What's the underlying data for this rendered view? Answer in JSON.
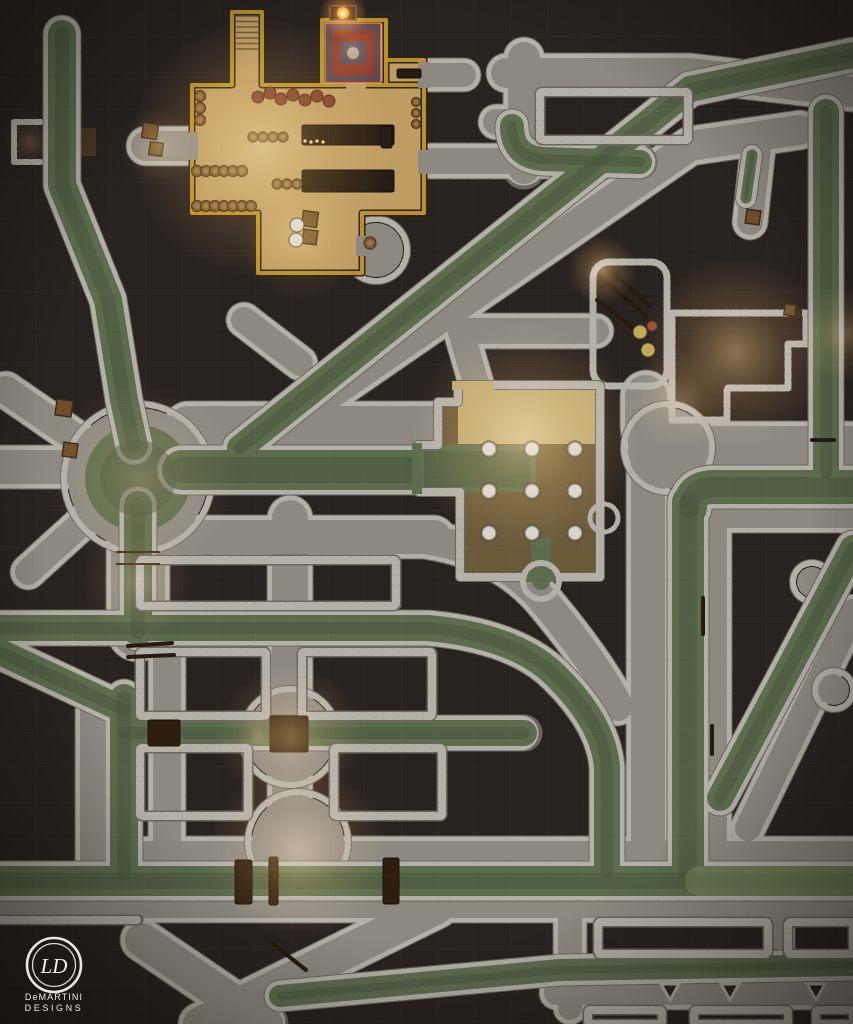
{
  "logo": {
    "monogram": "LD",
    "line1": "DeMARTINI",
    "line2": "DESIGNS"
  },
  "palette": {
    "bg": "#292320",
    "stone": "#b3b0a8",
    "joint": "#6b675f",
    "street": "#8d8981",
    "streetlit": "#b5a37c",
    "water": "#5c6d4e",
    "waterdark": "#46543c",
    "waterbright": "#7e9060",
    "tfloor": "#bf9c62",
    "gold": "#b8902c",
    "golddark": "#2e2312",
    "wood": "#3a2a16",
    "pillar": "#d8d4ca",
    "fire": "#ff8a30",
    "glow": "#f0a84f",
    "carpet_red": "#8a3b2c",
    "carpet_blue": "#3f5068"
  },
  "grid": {
    "size": 36.5,
    "line_opacity": 0.055
  },
  "map": {
    "streets": [
      {
        "d": "M146,146 H198",
        "w": 30
      },
      {
        "d": "M430,75 H464",
        "w": 24
      },
      {
        "d": "M506,73 H690 L853,92",
        "w": 30
      },
      {
        "d": "M524,58 V168",
        "w": 32
      },
      {
        "d": "M522,122 H496",
        "w": 26
      },
      {
        "d": "M430,161 H640",
        "w": 26
      },
      {
        "d": "M800,130 L690,146 L236,459",
        "w": 30
      },
      {
        "d": "M244,320 L300,363",
        "w": 26
      },
      {
        "d": "M470,331 H596",
        "w": 26
      },
      {
        "d": "M646,396 V424 Q646,447 670,447 H853",
        "w": 42
      },
      {
        "d": "M716,440 V872",
        "w": 22
      },
      {
        "d": "M648,460 V872",
        "w": 34
      },
      {
        "d": "M430,540 Q505,552 548,606 Q596,664 618,706",
        "w": 30
      },
      {
        "d": "M158,537 H434",
        "w": 34
      },
      {
        "d": "M290,518 V872",
        "w": 36
      },
      {
        "d": "M138,504 V630",
        "w": 54
      },
      {
        "d": "M0,467 H94",
        "w": 34
      },
      {
        "d": "M6,390 L96,452",
        "w": 28
      },
      {
        "d": "M28,572 L94,512",
        "w": 26
      },
      {
        "d": "M160,512 L208,542",
        "w": 26
      },
      {
        "d": "M188,426 H456",
        "w": 40
      },
      {
        "d": "M148,854 H853",
        "w": 26
      },
      {
        "d": "M0,907 H853",
        "w": 22
      },
      {
        "d": "M92,700 V862",
        "w": 24
      },
      {
        "d": "M167,648 V856",
        "w": 28
      },
      {
        "d": "M437,907 L200,1024",
        "w": 34
      },
      {
        "d": "M142,940 L266,1024",
        "w": 34
      },
      {
        "d": "M570,893 V1008",
        "w": 24
      },
      {
        "d": "M556,993 H853",
        "w": 24
      },
      {
        "d": "M780,918 V958",
        "w": 20
      },
      {
        "d": "M853,612 L748,828",
        "w": 26
      },
      {
        "d": "M758,148 L750,222",
        "w": 26
      },
      {
        "d": "M460,328 L478,390",
        "w": 26
      },
      {
        "d": "M710,518 H853",
        "w": 20
      }
    ],
    "aprons": [
      [
        138,
        478,
        70
      ],
      [
        290,
        737,
        44
      ],
      [
        298,
        842,
        46
      ],
      [
        668,
        448,
        40
      ],
      [
        376,
        250,
        27
      ],
      [
        812,
        582,
        15
      ],
      [
        834,
        690,
        15
      ]
    ],
    "channels": [
      {
        "d": "M62,34 V185 L108,300 L124,400 L134,446",
        "w": 28
      },
      {
        "d": "M182,470 H444",
        "w": 40
      },
      {
        "d": "M138,505 V632",
        "w": 28
      },
      {
        "d": "M0,628 H428 Q518,636 558,678 Q604,724 607,768 V872",
        "w": 26
      },
      {
        "d": "M124,733 H524",
        "w": 26
      },
      {
        "d": "M124,698 V874",
        "w": 28
      },
      {
        "d": "M0,652 L124,710",
        "w": 26
      },
      {
        "d": "M0,881 H853",
        "w": 30
      },
      {
        "d": "M280,996 L560,970 L853,965",
        "w": 22
      },
      {
        "d": "M688,502 V874",
        "w": 32
      },
      {
        "d": "M853,487 H714 Q690,487 690,508",
        "w": 34
      },
      {
        "d": "M826,112 V472",
        "w": 26
      },
      {
        "d": "M853,55 L690,89 L240,448",
        "w": 26
      },
      {
        "d": "M512,126 Q512,156 542,159 L640,162",
        "w": 24
      },
      {
        "d": "M853,548 L720,798",
        "w": 26
      },
      {
        "d": "M752,155 L746,198",
        "w": 11
      },
      {
        "d": "M700,881 H853",
        "w": 30,
        "bright": true
      }
    ],
    "pools": [
      [
        138,
        478,
        53
      ]
    ],
    "pool_inner": [
      [
        138,
        478,
        38
      ]
    ],
    "blocks": [
      [
        140,
        560,
        256,
        46
      ],
      [
        140,
        652,
        126,
        64
      ],
      [
        302,
        652,
        130,
        64
      ],
      [
        140,
        748,
        108,
        68
      ],
      [
        334,
        748,
        108,
        68
      ],
      [
        540,
        92,
        148,
        48
      ],
      [
        598,
        922,
        170,
        32
      ],
      [
        788,
        922,
        65,
        32
      ],
      [
        588,
        1010,
        74,
        14
      ],
      [
        694,
        1010,
        94,
        14
      ],
      [
        816,
        1010,
        37,
        14
      ]
    ],
    "wall_segments": [
      [
        0,
        920,
        138,
        920
      ]
    ],
    "triangles": [
      [
        670,
        984
      ],
      [
        730,
        984
      ],
      [
        816,
        984
      ]
    ]
  },
  "rooms": {
    "tavern": {
      "floor_d": "M192,85 L232,85 L232,12 L262,12 L262,85 L322,85 L322,20 L386,20 L386,60 L424,60 L424,213 L362,213 L362,273 L258,273 L258,213 L192,213 Z",
      "interior_d": "M322,85 L424,85 M386,20 L386,85",
      "door_rects": [
        [
          186,
          132,
          12,
          28,
          "s"
        ],
        [
          418,
          62,
          12,
          26,
          "s"
        ],
        [
          418,
          150,
          12,
          24,
          "s"
        ],
        [
          356,
          236,
          12,
          20,
          "s"
        ],
        [
          346,
          81,
          20,
          8,
          "f"
        ]
      ]
    },
    "pillar_room": {
      "floor_d": "M438,402 L458,402 L458,385 L600,385 L600,577 L460,577 L460,492 L418,492 L418,445 L438,445 Z",
      "floor_color": "#6a5a3a",
      "lit_rect": [
        458,
        386,
        142,
        58,
        "#bfa871"
      ],
      "pool_rect": [
        418,
        445,
        118,
        47
      ],
      "pool_dark": [
        424,
        451,
        106,
        36
      ],
      "stub_rect": [
        531,
        538,
        20,
        40
      ],
      "gaps": [
        [
          452,
          381,
          42,
          9,
          "#bfa871"
        ],
        [
          412,
          443,
          10,
          51,
          "w"
        ],
        [
          526,
          572,
          30,
          10,
          "w"
        ]
      ],
      "outfall": [
        541,
        581,
        18,
        9
      ],
      "bump": [
        604,
        518,
        14
      ]
    },
    "platform": [
      593,
      262,
      74,
      124,
      16
    ],
    "courtyard": {
      "d": "M672,313 L806,313 L806,344 L788,344 L788,388 L727,388 L727,420 L672,420 Z",
      "floor_color": "#a8977b",
      "door": [
        788,
        308,
        14,
        10
      ]
    },
    "alcove": [
      14,
      122,
      48,
      40
    ],
    "gate": [
      70,
      128,
      26,
      28
    ]
  },
  "props": {
    "bridges": [
      [
        235,
        860,
        17,
        44
      ],
      [
        269,
        857,
        9,
        48
      ],
      [
        383,
        858,
        16,
        46
      ],
      [
        270,
        716,
        38,
        36
      ],
      [
        148,
        720,
        32,
        26
      ]
    ],
    "beams": [
      [
        128,
        646,
        172,
        643
      ],
      [
        128,
        657,
        174,
        655
      ],
      [
        273,
        944,
        306,
        970
      ],
      [
        600,
        276,
        646,
        316
      ],
      [
        610,
        270,
        650,
        306
      ],
      [
        597,
        300,
        638,
        332
      ],
      [
        703,
        598,
        703,
        634
      ],
      [
        712,
        726,
        712,
        754
      ],
      [
        812,
        440,
        834,
        440
      ]
    ],
    "rails": [
      [
        116,
        552,
        160,
        552
      ],
      [
        116,
        564,
        160,
        564
      ]
    ],
    "crates": [
      [
        150,
        131,
        15
      ],
      [
        156,
        149,
        13
      ],
      [
        64,
        408,
        16
      ],
      [
        70,
        450,
        14
      ],
      [
        753,
        217,
        14
      ],
      [
        790,
        310,
        11
      ],
      [
        310,
        219,
        15
      ],
      [
        310,
        237,
        14
      ]
    ],
    "sacks": [
      [
        640,
        332,
        7,
        "#c2a85a"
      ],
      [
        648,
        350,
        7,
        "#c2a85a"
      ],
      [
        297,
        225,
        7,
        "#d8d2c4"
      ],
      [
        296,
        240,
        7,
        "#d8d2c4"
      ],
      [
        652,
        326,
        5,
        "#a84a30"
      ]
    ],
    "barrels": [
      [
        197,
        171,
        5.5
      ],
      [
        206,
        171,
        5.5
      ],
      [
        215,
        171,
        5.5
      ],
      [
        224,
        171,
        5.5
      ],
      [
        233,
        171,
        5.5
      ],
      [
        242,
        171,
        5.5
      ],
      [
        197,
        206,
        5.5
      ],
      [
        206,
        206,
        5.5
      ],
      [
        215,
        206,
        5.5
      ],
      [
        224,
        206,
        5.5
      ],
      [
        233,
        206,
        5.5
      ],
      [
        242,
        206,
        5.5
      ],
      [
        251,
        206,
        5.5
      ],
      [
        200,
        96,
        5.5
      ],
      [
        200,
        108,
        5.5
      ],
      [
        200,
        120,
        5.5
      ],
      [
        253,
        137,
        5
      ],
      [
        263,
        137,
        5
      ],
      [
        273,
        137,
        5
      ],
      [
        283,
        137,
        5
      ],
      [
        277,
        184,
        5
      ],
      [
        287,
        184,
        5
      ],
      [
        297,
        184,
        5
      ],
      [
        416,
        102,
        4.5
      ],
      [
        416,
        113,
        4.5
      ],
      [
        416,
        124,
        4.5
      ],
      [
        370,
        243,
        6
      ]
    ],
    "red_sacks": [
      [
        258,
        97
      ],
      [
        270,
        93
      ],
      [
        281,
        99
      ],
      [
        293,
        95
      ],
      [
        305,
        100
      ],
      [
        317,
        96
      ],
      [
        329,
        101
      ]
    ],
    "tables": [
      [
        302,
        125,
        92,
        20
      ],
      [
        302,
        170,
        92,
        22
      ],
      [
        397,
        69,
        24,
        9
      ],
      [
        381,
        126,
        11,
        22
      ]
    ],
    "candles": [
      [
        305,
        141
      ],
      [
        311,
        142
      ],
      [
        317,
        141
      ],
      [
        323,
        142
      ]
    ],
    "rug": {
      "x": 325,
      "y": 23,
      "w": 56,
      "h": 60
    },
    "fireplace": {
      "x": 330,
      "y": 6,
      "w": 26,
      "h": 14
    },
    "stairs": {
      "x": 232,
      "y": 12,
      "w": 30,
      "steps": 7
    }
  },
  "pillars": {
    "xs": [
      489,
      532,
      575
    ],
    "ys": [
      449,
      491,
      533
    ],
    "r": 7
  },
  "lights": [
    [
      262,
      148,
      130,
      0.5,
      "warm"
    ],
    [
      300,
      238,
      60,
      0.28,
      "warm"
    ],
    [
      343,
      14,
      24,
      0.9,
      "fire"
    ],
    [
      352,
      48,
      36,
      0.3,
      "fire"
    ],
    [
      160,
      146,
      38,
      0.3,
      "warm"
    ],
    [
      30,
      142,
      26,
      0.2,
      "warm"
    ],
    [
      525,
      436,
      112,
      0.55,
      "warm"
    ],
    [
      735,
      352,
      95,
      0.5,
      "warm"
    ],
    [
      602,
      270,
      34,
      0.6,
      "warm"
    ],
    [
      680,
      400,
      50,
      0.35,
      "warm"
    ],
    [
      140,
      478,
      95,
      0.26,
      "warm"
    ],
    [
      138,
      582,
      55,
      0.3,
      "warm"
    ],
    [
      290,
      737,
      72,
      0.45,
      "warm"
    ],
    [
      298,
      850,
      88,
      0.5,
      "warm"
    ],
    [
      845,
      334,
      48,
      0.32,
      "warm"
    ],
    [
      258,
      736,
      20,
      0.3,
      "warm"
    ]
  ]
}
